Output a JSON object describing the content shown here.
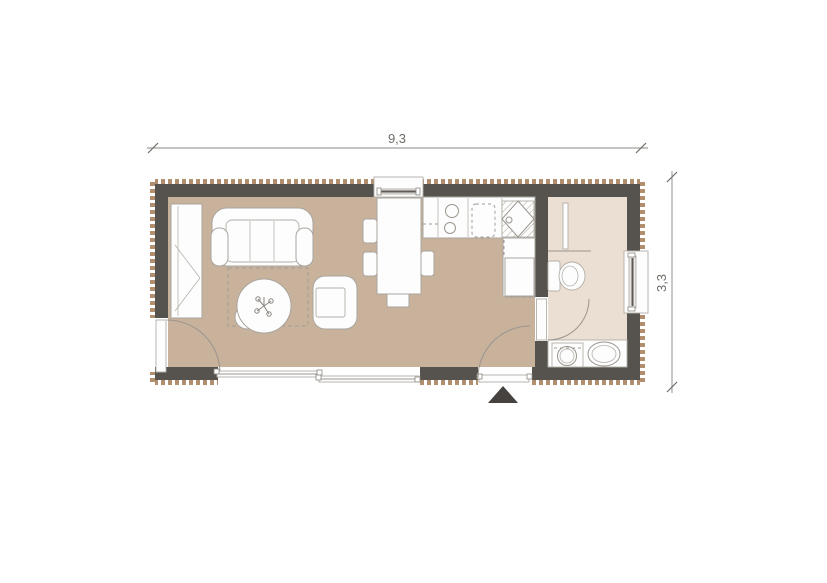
{
  "plan": {
    "title": "studio-cabin-floor-plan",
    "dimensions": {
      "width_label": "9,3",
      "height_label": "3,3"
    },
    "colors": {
      "wall": "#56534e",
      "living_floor": "#c9b29b",
      "bath_floor": "#eadfd2",
      "hatch": "#b08e6e",
      "furniture_fill": "#fdfdfd",
      "outline": "#9a958e",
      "marker": "#45423f"
    },
    "rooms": [
      {
        "name": "living-kitchen",
        "furniture": [
          "wardrobe",
          "sofa",
          "coffee-table",
          "plant",
          "stool",
          "armchair",
          "rug",
          "dining-table",
          "dining-chairs",
          "bench",
          "kitchen-counter",
          "stove",
          "cutting-board",
          "kitchen-sink",
          "refrigerator"
        ]
      },
      {
        "name": "bathroom",
        "fixtures": [
          "shower-screen",
          "toilet",
          "bathroom-counter",
          "washing-machine",
          "washbasin"
        ]
      }
    ],
    "openings": [
      "top-window",
      "right-window",
      "left-side-door",
      "sliding-glass-window",
      "entrance-door",
      "bathroom-door"
    ],
    "entrance_marker": "entrance-arrow"
  }
}
